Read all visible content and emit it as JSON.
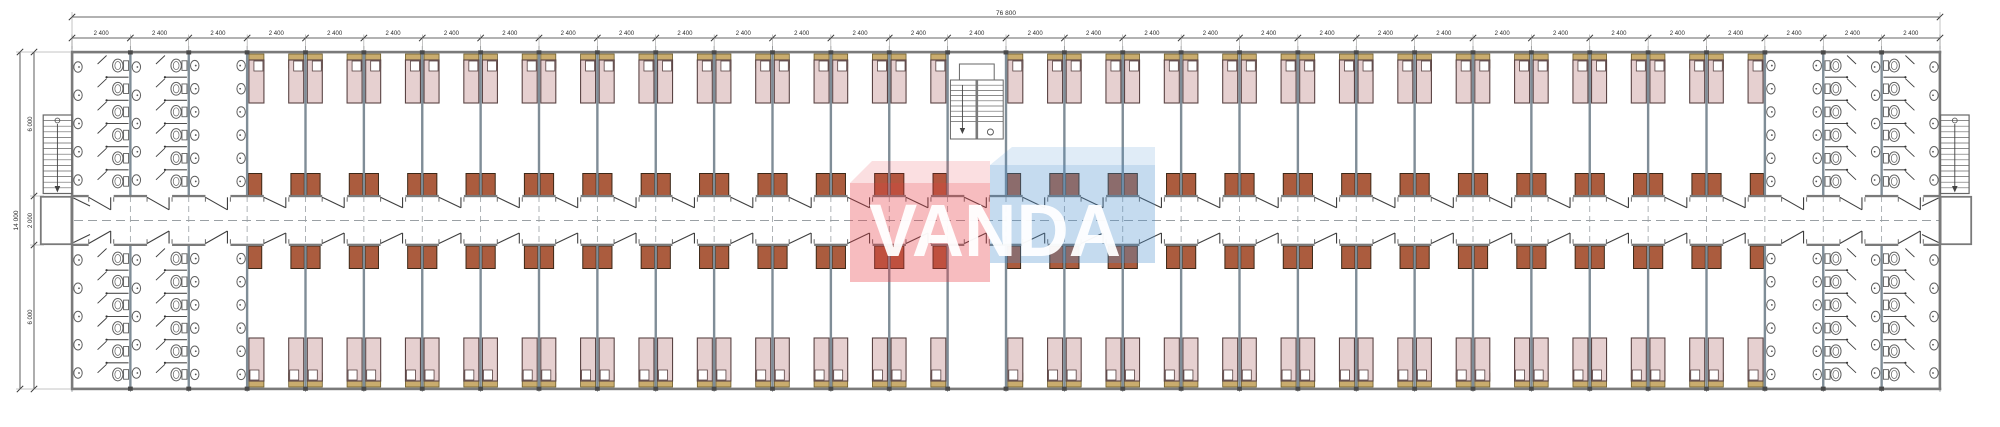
{
  "title": "dormitory-floor-plan",
  "watermark": {
    "text": "VANDA",
    "red_body": "rgba(232,58,66,0.34)",
    "red_top": "rgba(232,58,66,0.16)",
    "blue_body": "rgba(74,142,206,0.32)",
    "blue_top": "rgba(74,142,206,0.17)",
    "text_color": "rgba(255,255,255,0.95)"
  },
  "dimensions": {
    "top_total": "76 800",
    "top_bay_label": "2 400",
    "bay_count": 32,
    "left_total": "14 000",
    "left_segments": [
      "6 000",
      "2 000",
      "6 000"
    ]
  },
  "geometry": {
    "left": 72,
    "right": 1940,
    "bayWidth": 58.375,
    "topWall": 52,
    "corridorTop": 196,
    "corridorBottom": 245,
    "bottomWall": 389,
    "stairBay": 15,
    "roomFirstBoundary": 3,
    "roomLastBoundary": 29,
    "bathToiletColsLeft": [
      0,
      1
    ],
    "bathWashColLeft": 2,
    "bathWashColRight": 29,
    "bathToiletColsRight": [
      30,
      31
    ],
    "toiletsPerColumn": 6,
    "sinksPerToiletColumn": 5,
    "sinksPerWashWall": 6
  },
  "colors": {
    "wall": "#7a7a7a",
    "partition": "#7f8d97",
    "block": "#4a4a4a",
    "bed": "#e6d0d0",
    "bedBorder": "#5a4444",
    "desk": "#c9ac6e",
    "deskBorder": "#6b5a28",
    "wardrobe": "#ab5c3e",
    "wardrobeBorder": "#3c2817",
    "fixture": "#ffffff",
    "fixtureBorder": "#5f5f5f",
    "stall": "#4f4f4f",
    "door": "#3f3f3f",
    "dash": "#9aa0a4",
    "dimLine": "#333333",
    "stair": "#666666"
  }
}
